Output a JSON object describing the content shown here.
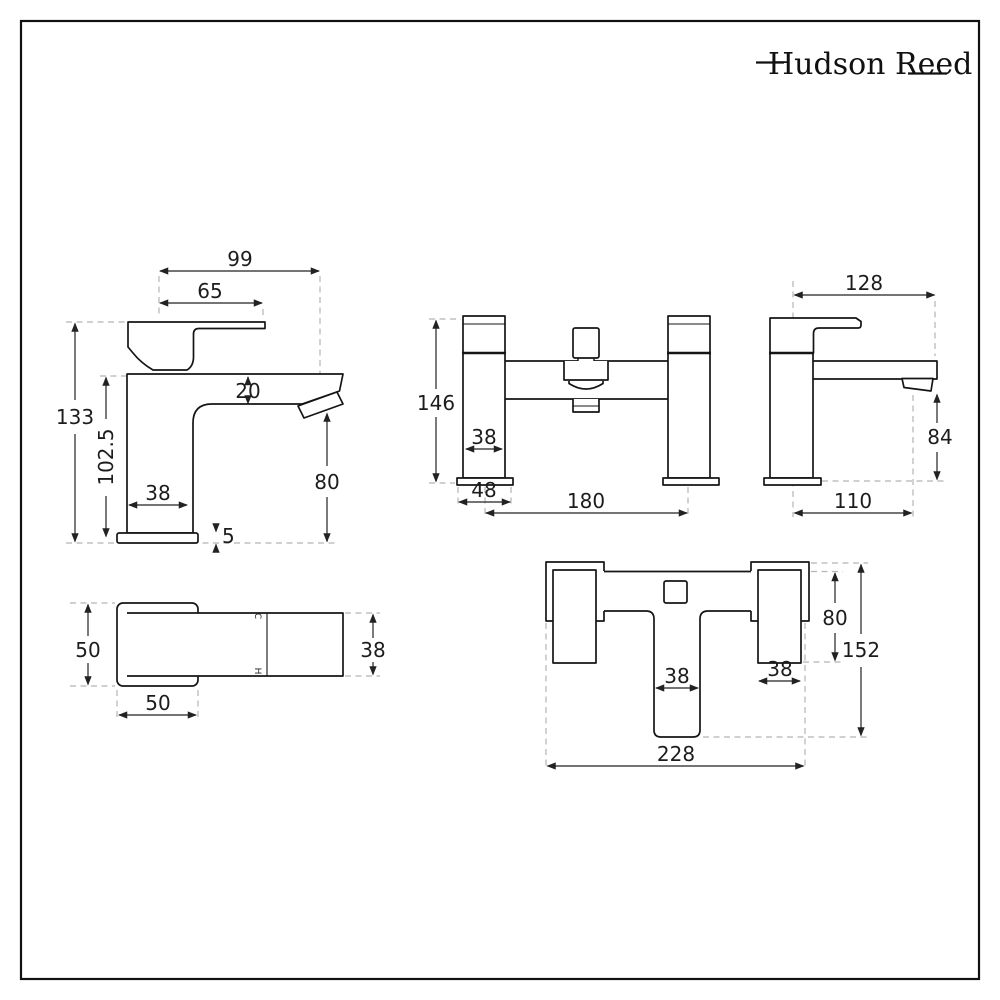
{
  "brand": {
    "name": "Hudson Reed"
  },
  "views": {
    "basin_side": {
      "dims": {
        "reach_overall": "99",
        "reach_handle": "65",
        "height_total": "133",
        "height_body": "102.5",
        "spout_thickness": "20",
        "spout_height": "80",
        "body_width": "38",
        "base_thickness": "5"
      }
    },
    "basin_top": {
      "dims": {
        "handle_width": "50",
        "handle_length": "50",
        "body_width": "38"
      },
      "marks": {
        "cold": "C",
        "hot": "H"
      }
    },
    "bath_front": {
      "dims": {
        "height": "146",
        "pillar_width": "38",
        "base_width": "48",
        "tap_centres": "180"
      }
    },
    "bath_side": {
      "dims": {
        "reach": "128",
        "spout_height": "84",
        "base_depth": "110"
      }
    },
    "bath_top": {
      "dims": {
        "handle_length": "80",
        "depth_total": "152",
        "spout_width": "38",
        "handle_width": "38",
        "width_total": "228"
      }
    }
  }
}
